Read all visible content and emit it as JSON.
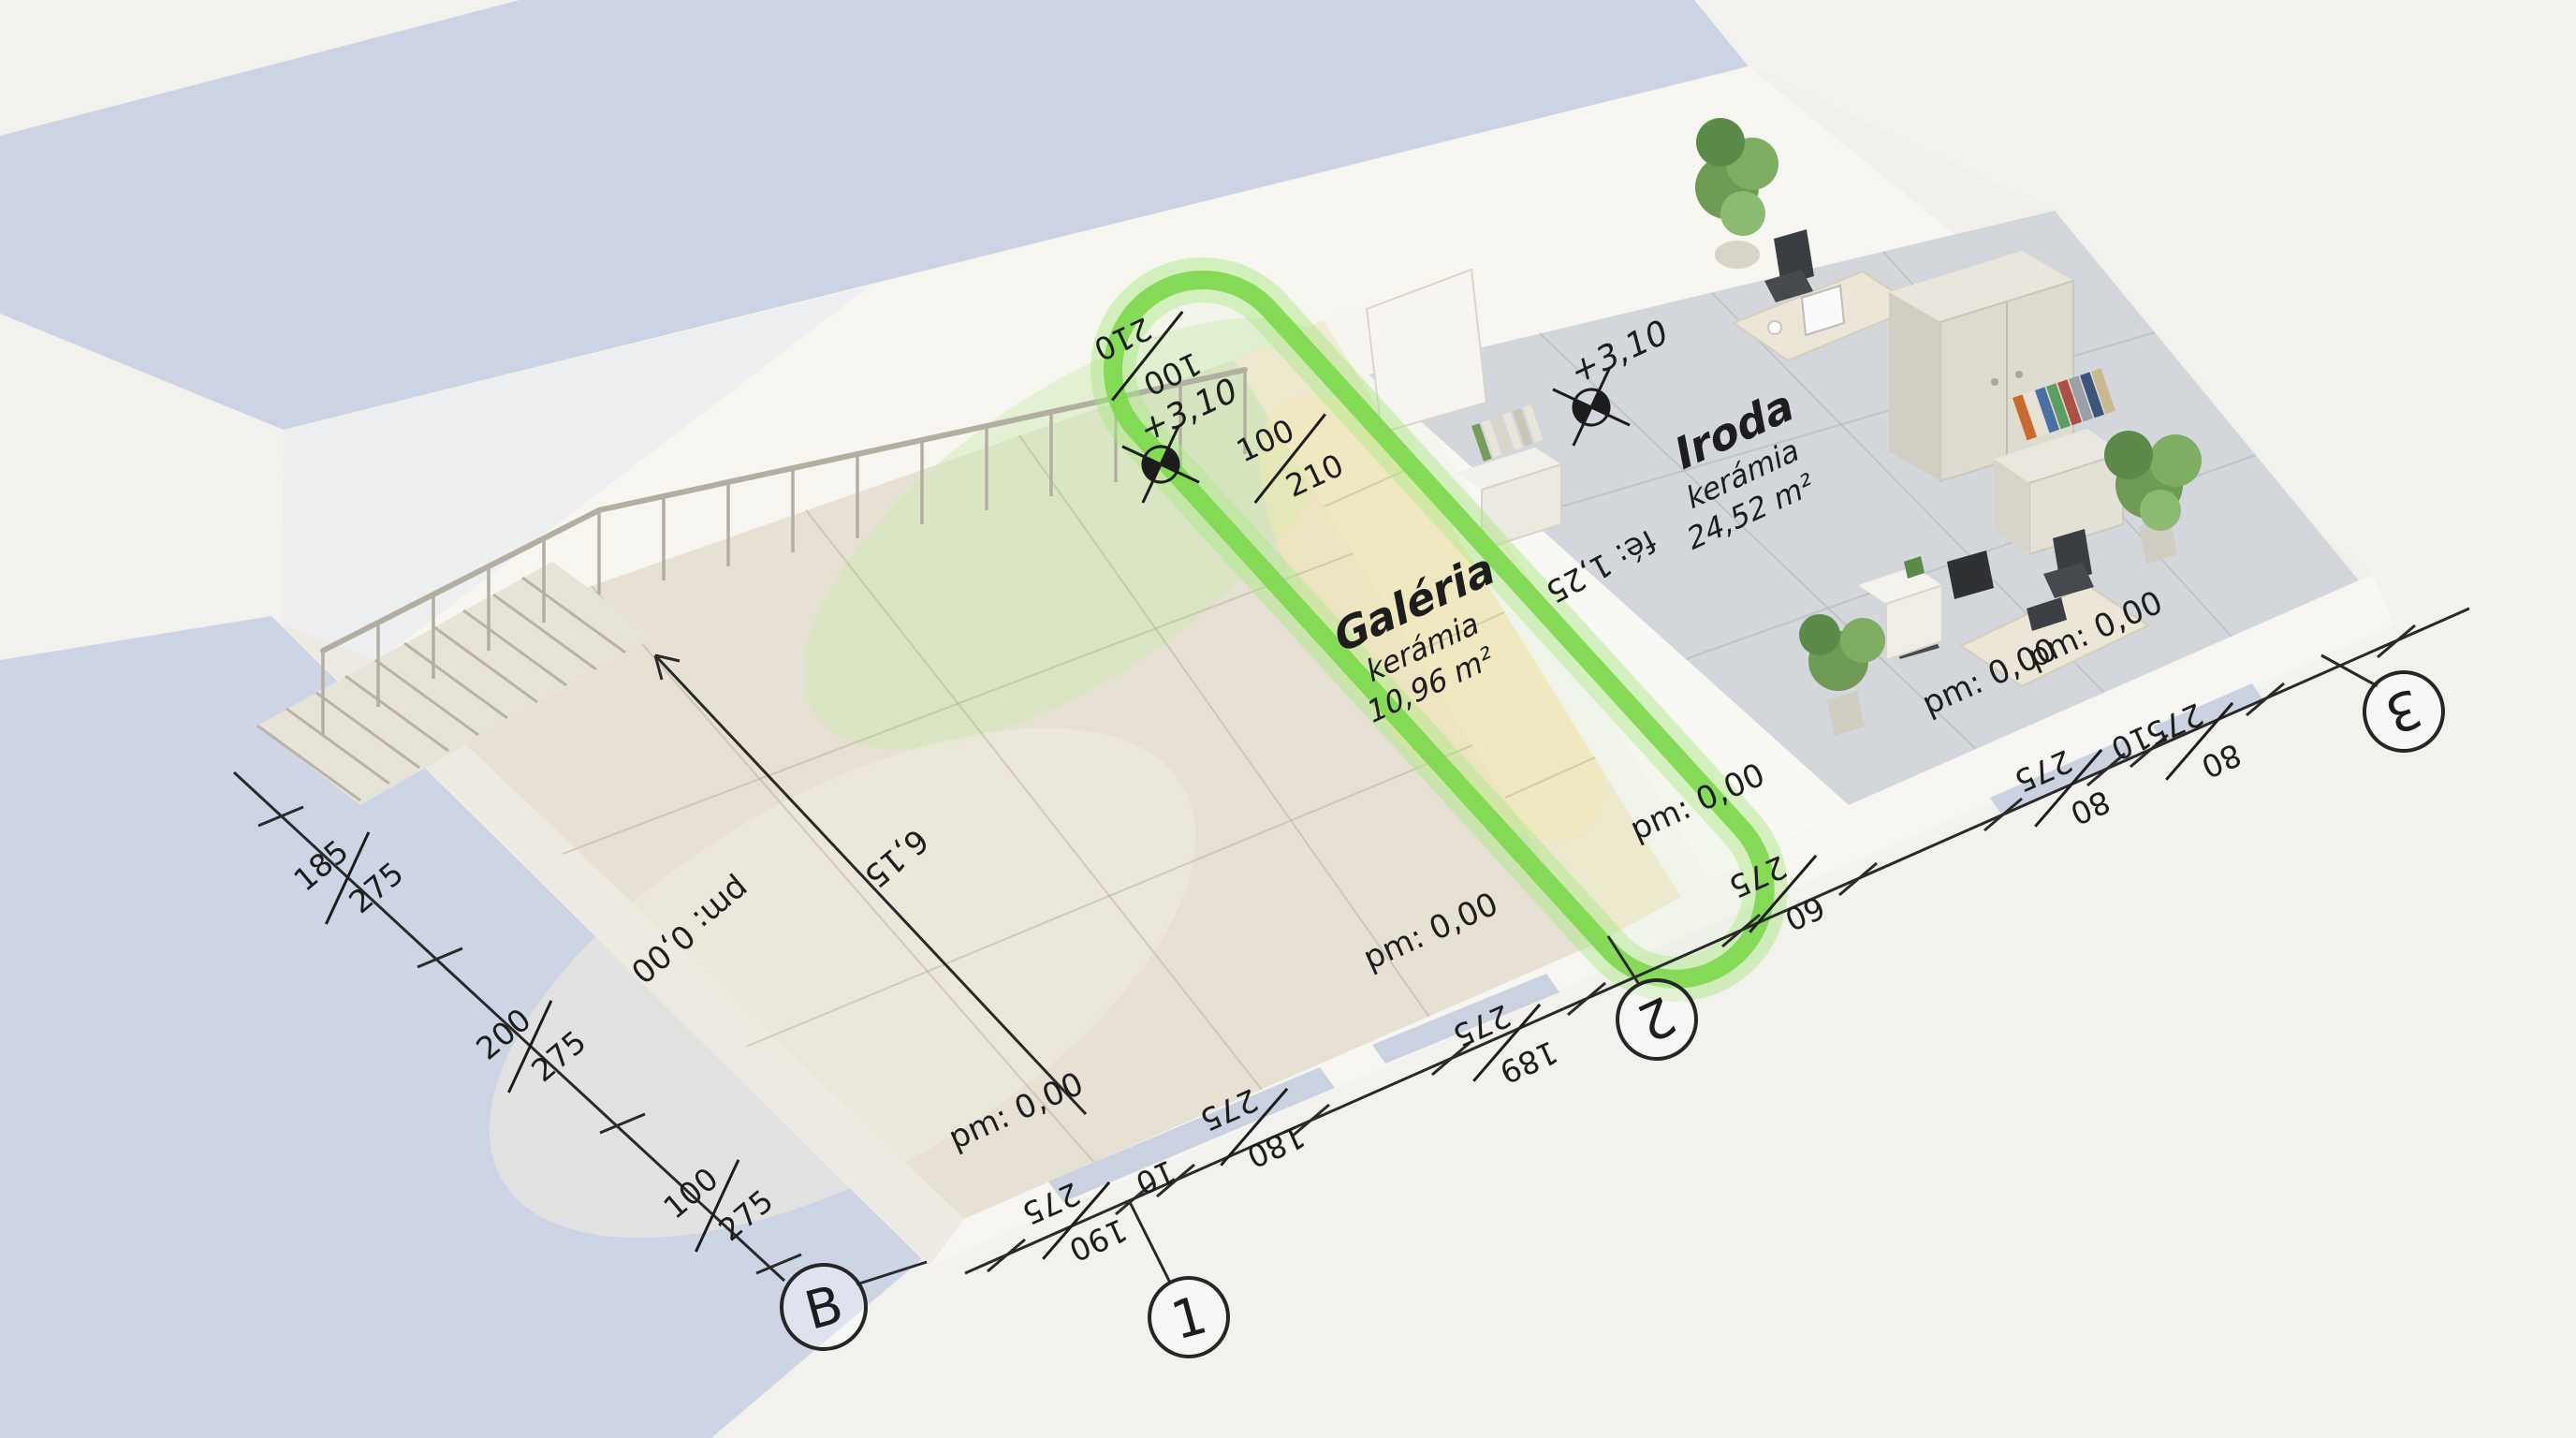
{
  "colors": {
    "accent_green": "#7ed94e",
    "accent_green_glow": "#a8e87f",
    "floor_gray": "#d3d6db",
    "floor_beige": "#e6e1d4",
    "floor_cream": "#f1ead4",
    "shadow_blue": "#ccd4e3",
    "wall_white": "#f8f7f3",
    "line_dark": "#2a2a2a"
  },
  "rooms": {
    "galeria": {
      "name": "Galéria",
      "finish": "kerámia",
      "area": "10,96 m²",
      "elevation": "+3,10"
    },
    "iroda": {
      "name": "Iroda",
      "finish": "kerámia",
      "area": "24,52 m²",
      "elevation": "+3,10"
    }
  },
  "floor_labels": {
    "pm": "pm: 0,00",
    "parapet_height": "fé: 1,25",
    "span": "6,15"
  },
  "door_dims": [
    {
      "num": "100",
      "den": "210"
    },
    {
      "num": "100",
      "den": "210"
    }
  ],
  "grid": {
    "letter": "B",
    "numbers": [
      "1",
      "2",
      "3"
    ]
  },
  "dim_left": [
    {
      "num": "185",
      "den": "275"
    },
    {
      "num": "200",
      "den": "275"
    },
    {
      "num": "100",
      "den": "275"
    }
  ],
  "dim_bottom": [
    {
      "num": "190",
      "den": "275"
    },
    {
      "num": "10"
    },
    {
      "num": "180",
      "den": "275"
    },
    {
      "num": "189",
      "den": "275"
    },
    {
      "num": "60",
      "den": "275"
    },
    {
      "num": "80",
      "den": "275"
    },
    {
      "num": "10"
    },
    {
      "num": "80",
      "den": "275"
    }
  ]
}
